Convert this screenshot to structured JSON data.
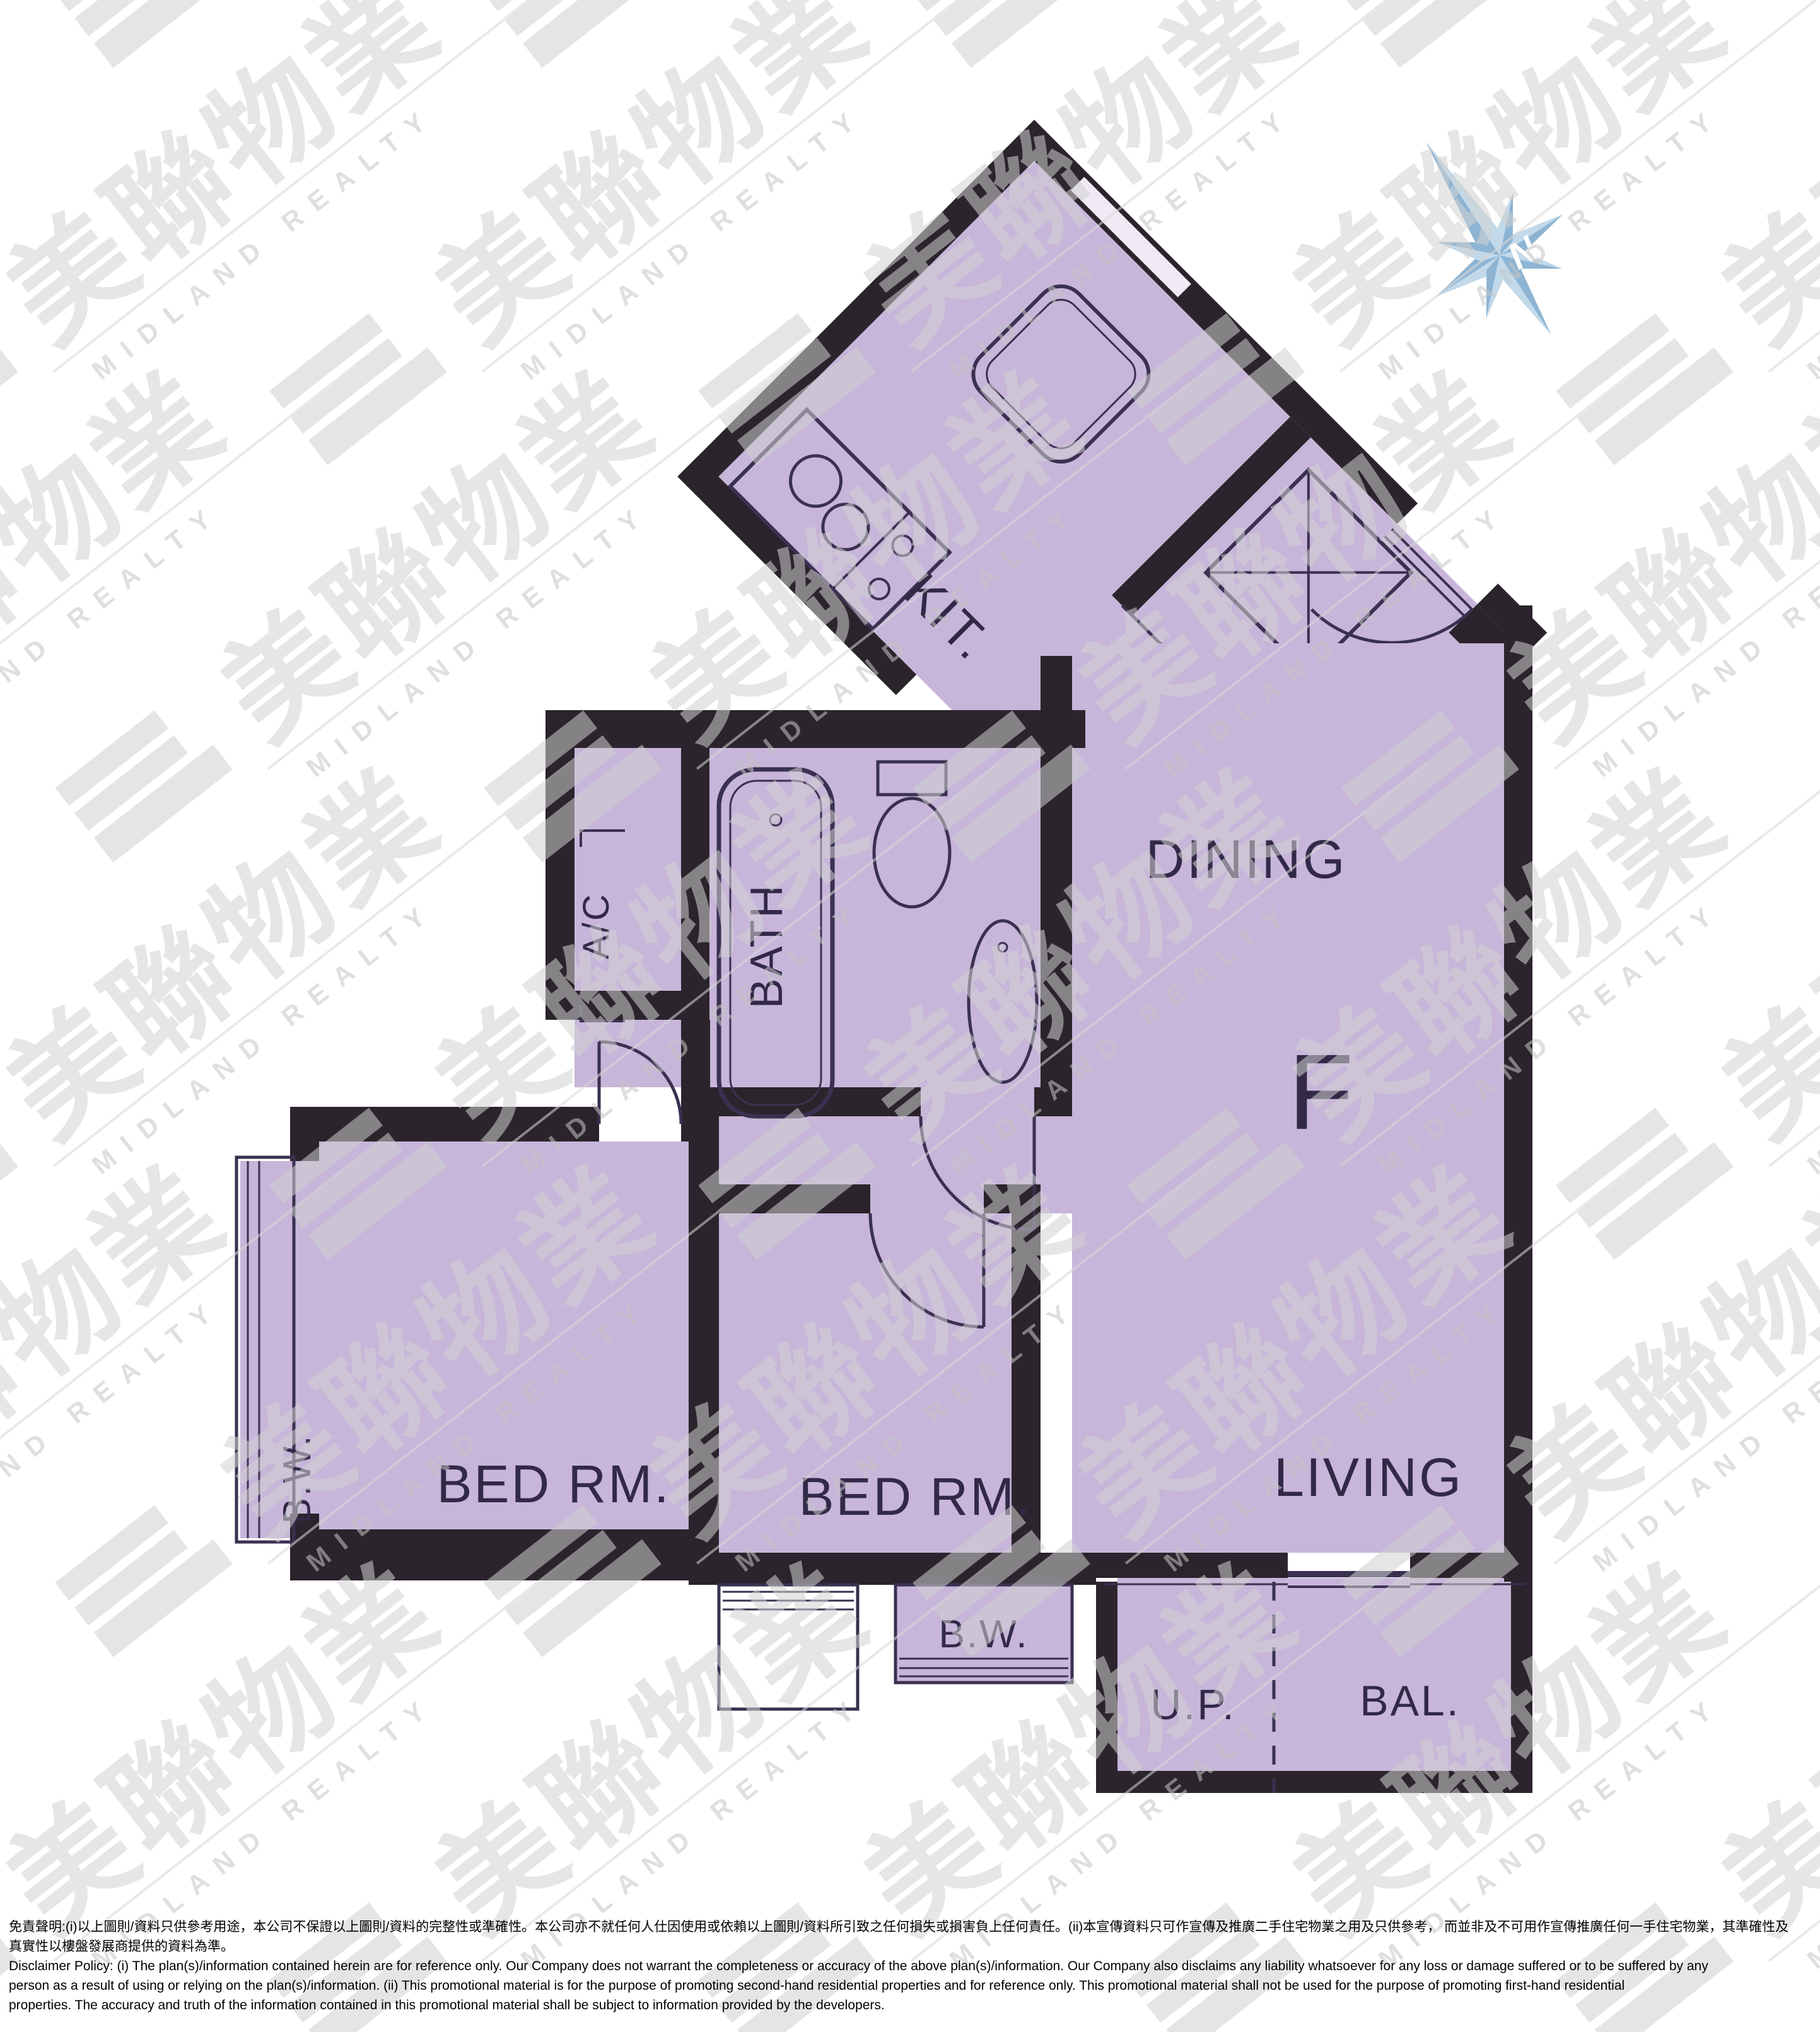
{
  "labels": {
    "kitchen": "KIT.",
    "dining": "DINING",
    "unit": "F",
    "living": "LIVING",
    "bath": "BATH",
    "ac": "A/C",
    "bed1": "BED RM.",
    "bed2": "BED RM.",
    "bw1": "B.W.",
    "bw2": "B.W.",
    "up": "U.P.",
    "bal": "BAL.",
    "north": "N"
  },
  "watermark": {
    "cjk": "美聯物業",
    "latin": "MIDLAND REALTY"
  },
  "disclaimer": {
    "zh1": "免責聲明:(i)以上圖則/資料只供參考用途，本公司不保證以上圖則/資料的完整性或準確性。本公司亦不就任何人仕因使用或依賴以上圖則/資料所引致之任何損失或損害負上任何責任。(ii)本宣傳資料只可作宣傳及推廣二手住宅物業之用及只供參考， 而並非及不可用作宣傳推廣任何一手住宅物業，其準確性及",
    "zh2": "真實性以樓盤發展商提供的資料為準。",
    "en1": "Disclaimer Policy: (i) The plan(s)/information contained herein are for reference only. Our Company does not warrant the completeness or accuracy of the above plan(s)/information. Our Company also disclaims any liability whatsoever for any loss or damage suffered or to be suffered by any",
    "en2": "person as a result of using or relying on the plan(s)/information. (ii) This promotional material is for the purpose of promoting second-hand residential properties and for reference only. This promotional material shall not be used for the purpose of promoting first-hand residential",
    "en3": "properties. The accuracy and truth of the information contained in this promotional material shall be subject to information provided by the developers."
  },
  "colors": {
    "plan_fill": "#c7b6d9",
    "wall": "#2b242c",
    "line_ink": "#3a3050",
    "label_ink": "#322947",
    "compass_blue_light": "#c2d9ea",
    "compass_blue_dark": "#8db4d3",
    "watermark_grey": "#d2d2d2"
  }
}
